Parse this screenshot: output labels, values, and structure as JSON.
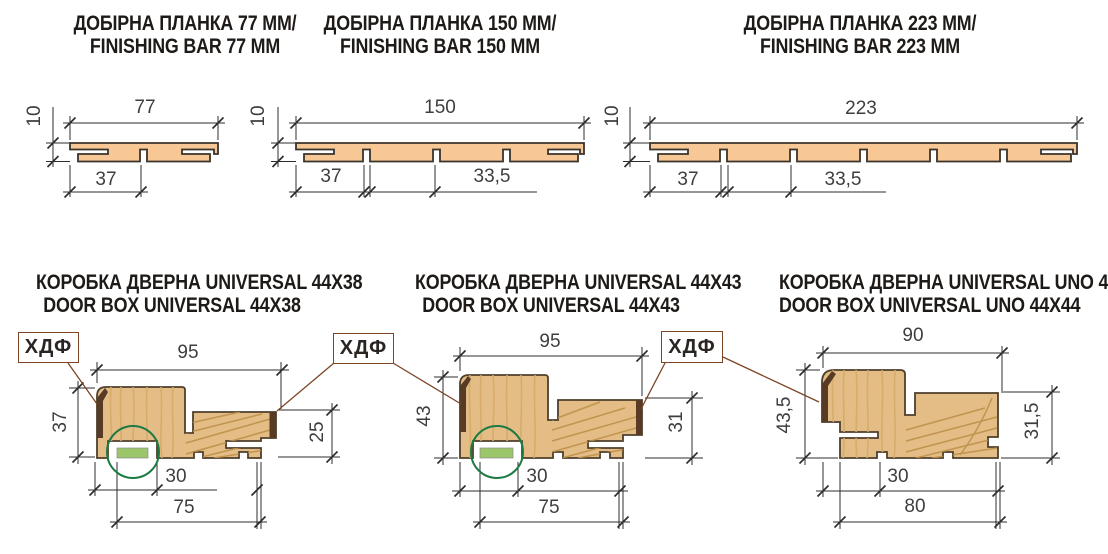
{
  "titles": {
    "p1": {
      "uk": "ДОБІРНА ПЛАНКА 77 ММ/",
      "en": "FINISHING BAR 77 MM"
    },
    "p2": {
      "uk": "ДОБІРНА ПЛАНКА 150 ММ/",
      "en": "FINISHING BAR 150 MM"
    },
    "p3": {
      "uk": "ДОБІРНА ПЛАНКА 223 ММ/",
      "en": "FINISHING BAR 223 MM"
    },
    "p4": {
      "uk": "КОРОБКА ДВЕРНА UNIVERSAL 44X38",
      "en": "DOOR BOX UNIVERSAL 44X38"
    },
    "p5": {
      "uk": "КОРОБКА ДВЕРНА UNIVERSAL 44X43",
      "en": "DOOR BOX UNIVERSAL 44X43"
    },
    "p6": {
      "uk": "КОРОБКА ДВЕРНА UNIVERSAL UNO 44X44",
      "en": "DOOR BOX UNIVERSAL UNO 44X44"
    }
  },
  "dims": {
    "p1": {
      "width": "77",
      "thickness": "10",
      "tongue": "37"
    },
    "p2": {
      "width": "150",
      "thickness": "10",
      "tongue": "37",
      "spacing": "33,5"
    },
    "p3": {
      "width": "223",
      "thickness": "10",
      "tongue": "37",
      "spacing": "33,5"
    },
    "p4": {
      "top": "95",
      "left": "37",
      "right": "25",
      "seal": "30",
      "bottom": "75"
    },
    "p5": {
      "top": "95",
      "left": "43",
      "right": "31",
      "seal": "30",
      "bottom": "75"
    },
    "p6": {
      "top": "90",
      "left": "43,5",
      "right": "31,5",
      "seal": "30",
      "bottom": "80"
    }
  },
  "hdf": {
    "label": "ХДФ"
  },
  "colors": {
    "plank_wood": "#f7c795",
    "frame_wood": "#e3bd85",
    "hdf_cap": "#573b25",
    "seal_green": "#9bc66a",
    "circle_green": "#1d7a44",
    "dimension_line": "#2e2d2e",
    "leader_line": "#7d4526"
  }
}
